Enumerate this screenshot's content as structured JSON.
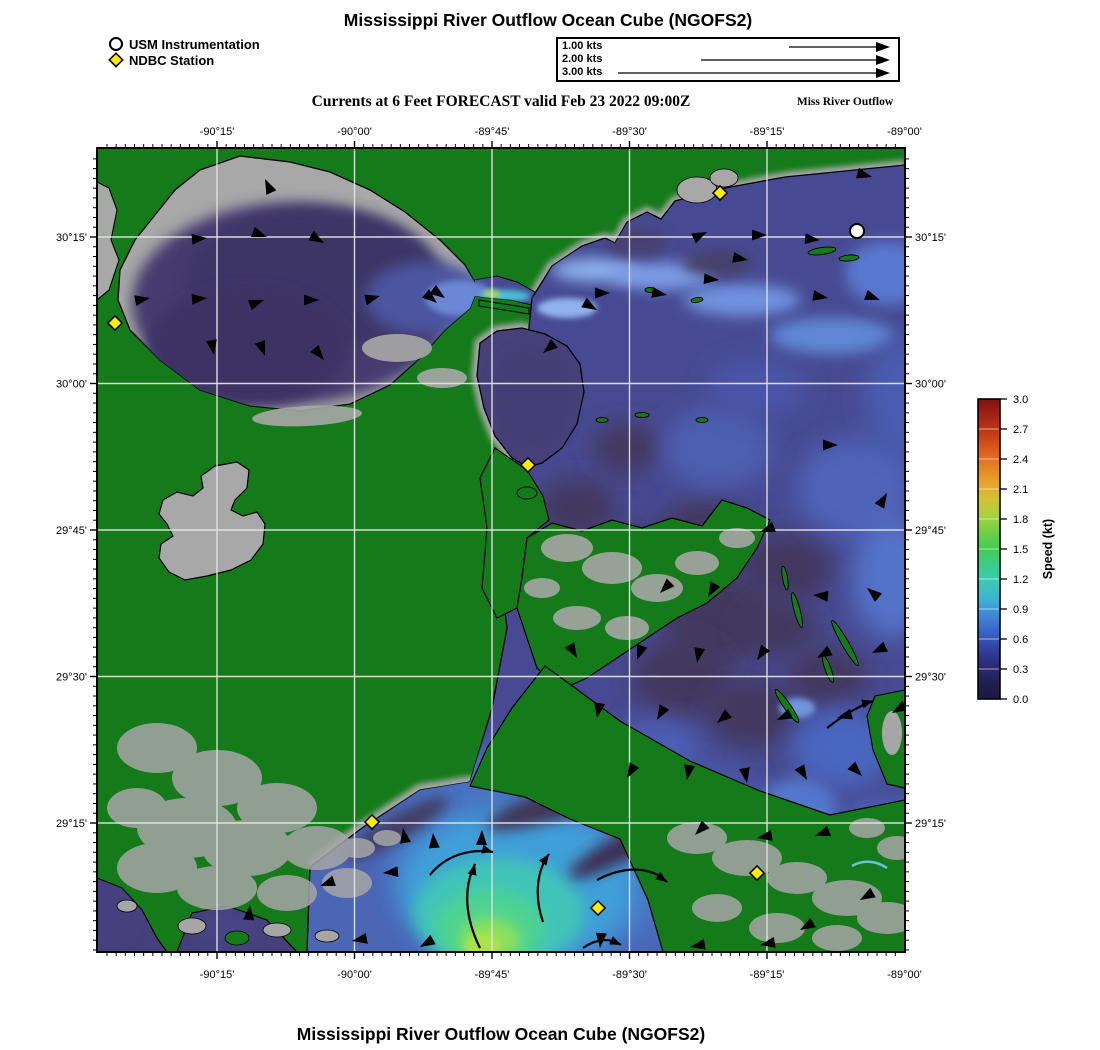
{
  "header": {
    "title": "Mississippi River Outflow Ocean Cube (NGOFS2)",
    "subtitle": "Currents at 6 Feet FORECAST valid Feb 23 2022 09:00Z",
    "annotation": "Miss River Outflow",
    "footer_title": "Mississippi River Outflow Ocean Cube (NGOFS2)"
  },
  "legend": {
    "items": [
      {
        "symbol": "circle-marker",
        "label": "USM Instrumentation"
      },
      {
        "symbol": "diamond-marker",
        "label": "NDBC Station"
      }
    ]
  },
  "scale_box": {
    "unit": "kts",
    "items": [
      {
        "label": "1.00 kts",
        "value": 1
      },
      {
        "label": "2.00 kts",
        "value": 2
      },
      {
        "label": "3.00 kts",
        "value": 3
      }
    ]
  },
  "axes": {
    "lon_ticks": [
      {
        "label": "-90°15'",
        "x": 120
      },
      {
        "label": "-90°00'",
        "x": 257.5
      },
      {
        "label": "-89°45'",
        "x": 395
      },
      {
        "label": "-89°30'",
        "x": 532.5
      },
      {
        "label": "-89°15'",
        "x": 670
      },
      {
        "label": "-89°00'",
        "x": 807.5
      }
    ],
    "lat_ticks": [
      {
        "label": "30°15'",
        "y": 89
      },
      {
        "label": "30°00'",
        "y": 235.5
      },
      {
        "label": "29°45'",
        "y": 382
      },
      {
        "label": "29°30'",
        "y": 528.5
      },
      {
        "label": "29°15'",
        "y": 675
      }
    ],
    "minor_lon_px": 9.1667,
    "minor_lat_px": 9.7667
  },
  "colorbar": {
    "label": "Speed (kt)",
    "min": 0.0,
    "max": 3.0,
    "ticks": [
      "3.0",
      "2.7",
      "2.4",
      "2.1",
      "1.8",
      "1.5",
      "1.2",
      "0.9",
      "0.6",
      "0.3",
      "0.0"
    ],
    "gradient_top_to_bottom": [
      "#7f1310",
      "#a32313",
      "#c23a16",
      "#d95a1c",
      "#e67f24",
      "#e8a32c",
      "#d3c234",
      "#a8d23c",
      "#6ed045",
      "#43cd53",
      "#3bcd8c",
      "#39c9b4",
      "#3fb3d2",
      "#3f86d6",
      "#3a62c6",
      "#3340a0",
      "#2b2c74",
      "#221f52",
      "#1c1940"
    ]
  },
  "map": {
    "stations": {
      "ndbc": [
        [
          18,
          175
        ],
        [
          623,
          45
        ],
        [
          431,
          317
        ],
        [
          275,
          674
        ],
        [
          501,
          760
        ],
        [
          660,
          725
        ]
      ],
      "usm": [
        [
          760,
          83
        ]
      ]
    },
    "arrows": [
      [
        168,
        31,
        -115
      ],
      [
        110,
        90,
        -5
      ],
      [
        170,
        89,
        20
      ],
      [
        227,
        95,
        30
      ],
      [
        53,
        150,
        -10
      ],
      [
        110,
        150,
        -5
      ],
      [
        167,
        152,
        -20
      ],
      [
        222,
        152,
        0
      ],
      [
        283,
        148,
        -15
      ],
      [
        340,
        155,
        40
      ],
      [
        117,
        207,
        80
      ],
      [
        168,
        208,
        70
      ],
      [
        227,
        212,
        50
      ],
      [
        348,
        150,
        35
      ],
      [
        610,
        84,
        -25
      ],
      [
        670,
        87,
        0
      ],
      [
        723,
        92,
        5
      ],
      [
        775,
        29,
        15
      ],
      [
        651,
        112,
        10
      ],
      [
        513,
        145,
        0
      ],
      [
        570,
        147,
        10
      ],
      [
        622,
        132,
        5
      ],
      [
        731,
        150,
        10
      ],
      [
        783,
        152,
        20
      ],
      [
        446,
        205,
        140
      ],
      [
        500,
        162,
        30
      ],
      [
        663,
        384,
        160
      ],
      [
        716,
        447,
        -175
      ],
      [
        770,
        440,
        -140
      ],
      [
        611,
        449,
        120
      ],
      [
        563,
        445,
        135
      ],
      [
        741,
        297,
        0
      ],
      [
        790,
        345,
        -60
      ],
      [
        480,
        510,
        60
      ],
      [
        540,
        512,
        110
      ],
      [
        600,
        515,
        100
      ],
      [
        660,
        512,
        125
      ],
      [
        720,
        510,
        150
      ],
      [
        775,
        505,
        155
      ],
      [
        500,
        570,
        100
      ],
      [
        560,
        572,
        120
      ],
      [
        620,
        575,
        140
      ],
      [
        680,
        572,
        155
      ],
      [
        740,
        570,
        165
      ],
      [
        795,
        565,
        150
      ],
      [
        530,
        630,
        120
      ],
      [
        590,
        632,
        100
      ],
      [
        650,
        635,
        80
      ],
      [
        710,
        632,
        60
      ],
      [
        765,
        628,
        45
      ],
      [
        598,
        687,
        135
      ],
      [
        660,
        690,
        170
      ],
      [
        718,
        688,
        160
      ],
      [
        223,
        738,
        160
      ],
      [
        286,
        725,
        175
      ],
      [
        153,
        757,
        -85
      ],
      [
        306,
        680,
        -100
      ],
      [
        336,
        685,
        -95
      ],
      [
        385,
        682,
        -88
      ],
      [
        255,
        793,
        170
      ],
      [
        323,
        799,
        150
      ],
      [
        503,
        800,
        95
      ],
      [
        593,
        799,
        170
      ],
      [
        663,
        797,
        170
      ],
      [
        703,
        782,
        150
      ],
      [
        763,
        752,
        150
      ]
    ],
    "curved_arrows": [
      {
        "d": "M383,800 C368,770 366,740 378,716",
        "hx": 378,
        "hy": 716,
        "hr": -75
      },
      {
        "d": "M446,774 C437,748 440,722 452,706",
        "hx": 452,
        "hy": 706,
        "hr": -55
      },
      {
        "d": "M333,727 C348,708 372,700 396,704",
        "hx": 396,
        "hy": 704,
        "hr": 15
      },
      {
        "d": "M500,732 C530,716 556,720 570,734",
        "hx": 570,
        "hy": 734,
        "hr": 35
      },
      {
        "d": "M486,800 C500,790 514,790 524,797",
        "hx": 524,
        "hy": 797,
        "hr": 25
      },
      {
        "d": "M730,580 C748,566 762,558 776,553",
        "hx": 776,
        "hy": 553,
        "hr": -15
      }
    ]
  },
  "colors": {
    "land_green": "#147a1a",
    "shore_gray": "#a8a8a8",
    "lake_purple": "#453a6e",
    "sound_blue": "#474a92",
    "gulf_blue": "#4a66b5",
    "plume_green": "#8fe05a",
    "gridline": "#e3e3e3",
    "ndbc_yellow": "#ffec00",
    "usm_white": "#ffffff",
    "arrow_black": "#000000"
  }
}
